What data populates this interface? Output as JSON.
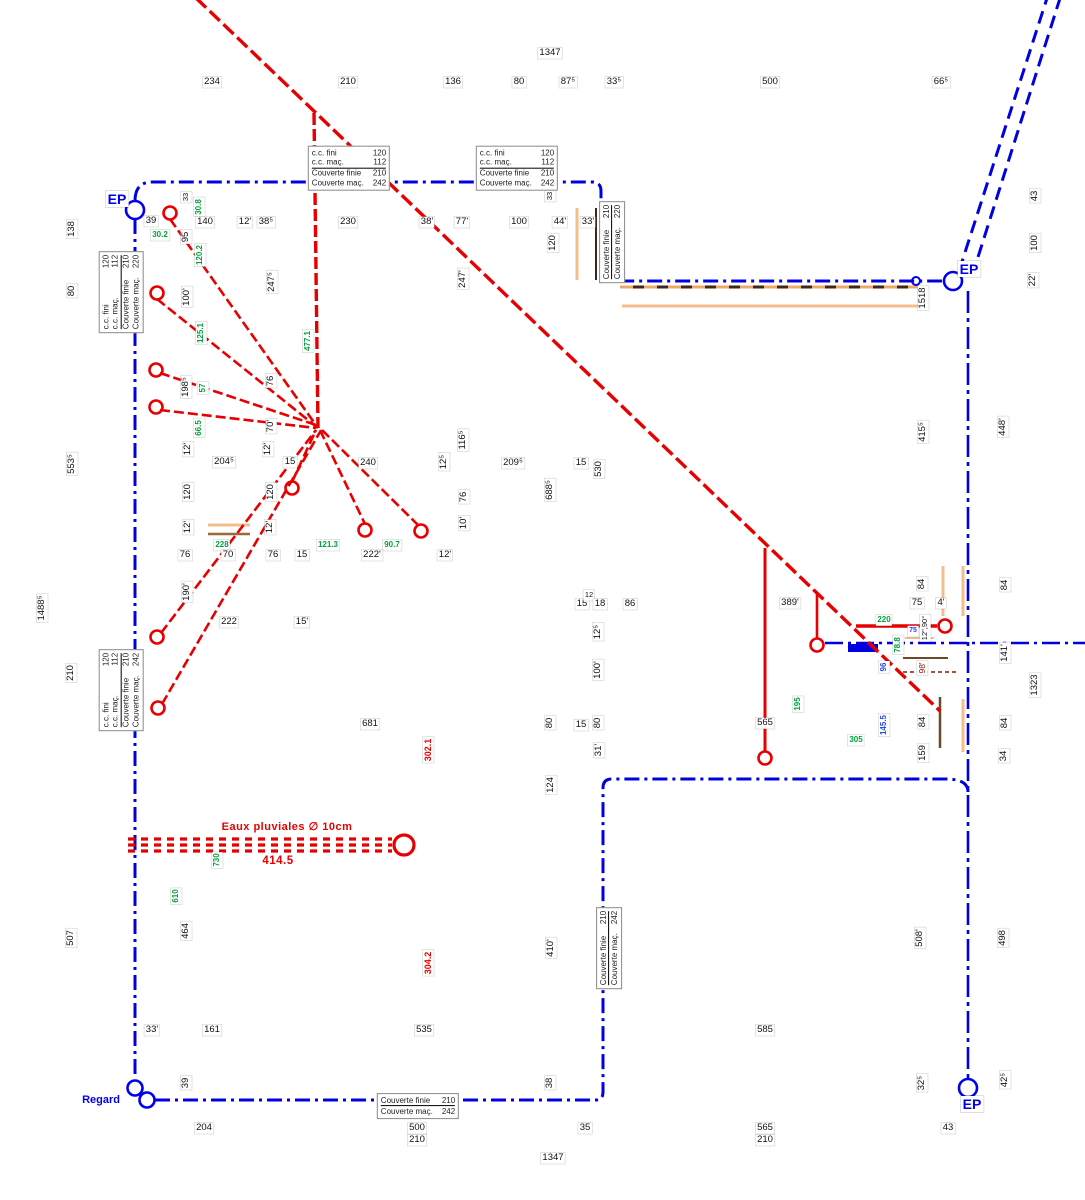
{
  "drawing": {
    "ep_label": "EP",
    "regard_label": "Regard",
    "colors": {
      "boundary_blue": "#0000e0",
      "pipe_red": "#e80000",
      "elevation_green": "#00a33d",
      "note_blue": "#2847e8",
      "note_darkred": "#8b1a00",
      "tan": "#f0b888"
    }
  },
  "infoboxes": [
    {
      "x": 349,
      "y": 168,
      "rot": 0,
      "div": 1,
      "rows": [
        [
          "c.c. fini",
          "120"
        ],
        [
          "c.c. maç.",
          "112"
        ],
        [
          "Couverte finie",
          "210"
        ],
        [
          "Couverte maç.",
          "242"
        ]
      ]
    },
    {
      "x": 517,
      "y": 168,
      "rot": 0,
      "div": 1,
      "rows": [
        [
          "c.c. fini",
          "120"
        ],
        [
          "c.c. maç.",
          "112"
        ],
        [
          "Couverte finie",
          "210"
        ],
        [
          "Couverte maç.",
          "242"
        ]
      ]
    },
    {
      "x": 121,
      "y": 292,
      "rot": 1,
      "div": 1,
      "rows": [
        [
          "c.c. fini",
          "120"
        ],
        [
          "c.c. maç.",
          "112"
        ],
        [
          "Couverte finie",
          "210"
        ],
        [
          "Couverte maç.",
          "220"
        ]
      ]
    },
    {
      "x": 121,
      "y": 690,
      "rot": 1,
      "div": 1,
      "rows": [
        [
          "c.c. fini",
          "120"
        ],
        [
          "c.c. maç.",
          "112"
        ],
        [
          "Couverte finie",
          "210"
        ],
        [
          "Couverte maç.",
          "242"
        ]
      ]
    },
    {
      "x": 612,
      "y": 242,
      "rot": 1,
      "div": 0,
      "rows": [
        [
          "Couverte finie",
          "210"
        ],
        [
          "Couverte maç.",
          "220"
        ]
      ]
    },
    {
      "x": 609,
      "y": 948,
      "rot": 1,
      "div": 0,
      "rows": [
        [
          "Couverte finie",
          "210"
        ],
        [
          "Couverte maç.",
          "242"
        ]
      ]
    },
    {
      "x": 418,
      "y": 1106,
      "rot": 0,
      "div": 0,
      "rows": [
        [
          "Couverte finie",
          "210"
        ],
        [
          "Couverte maç.",
          "242"
        ]
      ]
    }
  ],
  "ep_markers": [
    {
      "cx": 135,
      "cy": 210,
      "lx": 117,
      "ly": 199
    },
    {
      "cx": 953,
      "cy": 281,
      "lx": 969,
      "ly": 269
    },
    {
      "cx": 968,
      "cy": 1088,
      "lx": 972,
      "ly": 1104
    }
  ],
  "regard": {
    "x": 138,
    "y": 1100
  },
  "regard_circles": [
    [
      135,
      1088
    ],
    [
      147,
      1100
    ]
  ],
  "fixtures": [
    [
      170,
      213
    ],
    [
      157,
      293
    ],
    [
      156,
      370
    ],
    [
      156,
      407
    ],
    [
      292,
      488
    ],
    [
      365,
      530
    ],
    [
      421,
      531
    ],
    [
      157,
      637
    ],
    [
      158,
      708
    ],
    [
      765,
      758
    ],
    [
      817,
      645
    ],
    [
      945,
      626
    ]
  ],
  "labels": [
    {
      "t": "1347",
      "x": 550,
      "y": 53
    },
    {
      "t": "234",
      "x": 212,
      "y": 82
    },
    {
      "t": "210",
      "x": 348,
      "y": 82
    },
    {
      "t": "136",
      "x": 453,
      "y": 82
    },
    {
      "t": "80",
      "x": 519,
      "y": 82
    },
    {
      "t": "87⁵",
      "x": 568,
      "y": 82
    },
    {
      "t": "33⁵",
      "x": 614,
      "y": 82
    },
    {
      "t": "500",
      "x": 770,
      "y": 82
    },
    {
      "t": "66⁵",
      "x": 941,
      "y": 82
    },
    {
      "t": "33",
      "x": 186,
      "y": 197,
      "r": 1,
      "fs": 7.5
    },
    {
      "t": "39",
      "x": 151,
      "y": 221
    },
    {
      "t": "140",
      "x": 205,
      "y": 222
    },
    {
      "t": "12'",
      "x": 245,
      "y": 222
    },
    {
      "t": "38⁵",
      "x": 266,
      "y": 222
    },
    {
      "t": "230",
      "x": 348,
      "y": 222
    },
    {
      "t": "38'",
      "x": 427,
      "y": 222
    },
    {
      "t": "77'",
      "x": 462,
      "y": 222
    },
    {
      "t": "100",
      "x": 519,
      "y": 222
    },
    {
      "t": "44'",
      "x": 560,
      "y": 222
    },
    {
      "t": "33'",
      "x": 588,
      "y": 222
    },
    {
      "t": "33",
      "x": 550,
      "y": 196,
      "r": 1,
      "fs": 7.5
    },
    {
      "t": "120",
      "x": 553,
      "y": 243,
      "r": 1
    },
    {
      "t": "30.8",
      "x": 199,
      "y": 207,
      "r": 1,
      "c": "g"
    },
    {
      "t": "30.2",
      "x": 160,
      "y": 235,
      "c": "g"
    },
    {
      "t": "95",
      "x": 186,
      "y": 237,
      "r": 1
    },
    {
      "t": "120.2",
      "x": 200,
      "y": 255,
      "r": 1,
      "c": "g"
    },
    {
      "t": "100'",
      "x": 187,
      "y": 297,
      "r": 1
    },
    {
      "t": "247⁵",
      "x": 272,
      "y": 282,
      "r": 1
    },
    {
      "t": "247'",
      "x": 463,
      "y": 279,
      "r": 1
    },
    {
      "t": "138",
      "x": 72,
      "y": 229,
      "r": 1
    },
    {
      "t": "80",
      "x": 72,
      "y": 291,
      "r": 1
    },
    {
      "t": "553⁵",
      "x": 72,
      "y": 464,
      "r": 1
    },
    {
      "t": "1488⁵",
      "x": 42,
      "y": 608,
      "r": 1
    },
    {
      "t": "210",
      "x": 71,
      "y": 673,
      "r": 1
    },
    {
      "t": "507",
      "x": 71,
      "y": 938,
      "r": 1
    },
    {
      "t": "43",
      "x": 1035,
      "y": 196,
      "r": 1
    },
    {
      "t": "100",
      "x": 1035,
      "y": 243,
      "r": 1
    },
    {
      "t": "22'",
      "x": 1033,
      "y": 280,
      "r": 1
    },
    {
      "t": "1518",
      "x": 923,
      "y": 298,
      "r": 1
    },
    {
      "t": "415⁵",
      "x": 923,
      "y": 432,
      "r": 1
    },
    {
      "t": "448'",
      "x": 1003,
      "y": 427,
      "r": 1
    },
    {
      "t": "84",
      "x": 1005,
      "y": 585,
      "r": 1
    },
    {
      "t": "141'",
      "x": 1005,
      "y": 653,
      "r": 1
    },
    {
      "t": "1323",
      "x": 1035,
      "y": 685,
      "r": 1
    },
    {
      "t": "84",
      "x": 1005,
      "y": 723,
      "r": 1
    },
    {
      "t": "34",
      "x": 1004,
      "y": 756,
      "r": 1
    },
    {
      "t": "508'",
      "x": 920,
      "y": 938,
      "r": 1
    },
    {
      "t": "498",
      "x": 1003,
      "y": 938,
      "r": 1
    },
    {
      "t": "42⁵",
      "x": 1005,
      "y": 1080,
      "r": 1
    },
    {
      "t": "32⁵",
      "x": 922,
      "y": 1083,
      "r": 1
    },
    {
      "t": "198⁵",
      "x": 186,
      "y": 387,
      "r": 1
    },
    {
      "t": "125.1",
      "x": 201,
      "y": 333,
      "r": 1,
      "c": "g"
    },
    {
      "t": "57",
      "x": 203,
      "y": 388,
      "r": 1,
      "c": "g"
    },
    {
      "t": "66.5",
      "x": 199,
      "y": 428,
      "r": 1,
      "c": "g"
    },
    {
      "t": "76",
      "x": 271,
      "y": 381,
      "r": 1
    },
    {
      "t": "70'",
      "x": 271,
      "y": 426,
      "r": 1
    },
    {
      "t": "477.1",
      "x": 308,
      "y": 341,
      "r": 1,
      "c": "g"
    },
    {
      "t": "12'",
      "x": 188,
      "y": 449,
      "r": 1
    },
    {
      "t": "12'",
      "x": 268,
      "y": 449,
      "r": 1
    },
    {
      "t": "204⁵",
      "x": 224,
      "y": 462
    },
    {
      "t": "15",
      "x": 290,
      "y": 462
    },
    {
      "t": "240",
      "x": 368,
      "y": 463
    },
    {
      "t": "12⁵",
      "x": 444,
      "y": 462,
      "r": 1
    },
    {
      "t": "116⁵",
      "x": 463,
      "y": 440,
      "r": 1
    },
    {
      "t": "120",
      "x": 188,
      "y": 492,
      "r": 1
    },
    {
      "t": "120",
      "x": 271,
      "y": 492,
      "r": 1
    },
    {
      "t": "12'",
      "x": 188,
      "y": 527,
      "r": 1
    },
    {
      "t": "12'",
      "x": 270,
      "y": 527,
      "r": 1
    },
    {
      "t": "228",
      "x": 222,
      "y": 545,
      "c": "g"
    },
    {
      "t": "121.3",
      "x": 328,
      "y": 545,
      "c": "g"
    },
    {
      "t": "90.7",
      "x": 392,
      "y": 545,
      "c": "g"
    },
    {
      "t": "76",
      "x": 185,
      "y": 555
    },
    {
      "t": "70",
      "x": 228,
      "y": 555
    },
    {
      "t": "76",
      "x": 273,
      "y": 555
    },
    {
      "t": "15",
      "x": 302,
      "y": 555
    },
    {
      "t": "222'",
      "x": 372,
      "y": 555
    },
    {
      "t": "12'",
      "x": 445,
      "y": 555
    },
    {
      "t": "190'",
      "x": 187,
      "y": 592,
      "r": 1
    },
    {
      "t": "222",
      "x": 229,
      "y": 622
    },
    {
      "t": "15'",
      "x": 302,
      "y": 622
    },
    {
      "t": "209⁵",
      "x": 513,
      "y": 463
    },
    {
      "t": "15",
      "x": 581,
      "y": 463
    },
    {
      "t": "530",
      "x": 599,
      "y": 469,
      "r": 1
    },
    {
      "t": "688⁵",
      "x": 550,
      "y": 490,
      "r": 1
    },
    {
      "t": "76",
      "x": 464,
      "y": 497,
      "r": 1
    },
    {
      "t": "10'",
      "x": 464,
      "y": 523,
      "r": 1
    },
    {
      "t": "15",
      "x": 582,
      "y": 604
    },
    {
      "t": "12",
      "x": 589,
      "y": 595,
      "fs": 7.5
    },
    {
      "t": "18",
      "x": 600,
      "y": 604
    },
    {
      "t": "86",
      "x": 630,
      "y": 604
    },
    {
      "t": "12⁵",
      "x": 598,
      "y": 632,
      "r": 1
    },
    {
      "t": "100'",
      "x": 598,
      "y": 670,
      "r": 1
    },
    {
      "t": "80",
      "x": 550,
      "y": 723,
      "r": 1
    },
    {
      "t": "15",
      "x": 581,
      "y": 725
    },
    {
      "t": "80",
      "x": 598,
      "y": 723,
      "r": 1
    },
    {
      "t": "31'",
      "x": 599,
      "y": 750,
      "r": 1
    },
    {
      "t": "124",
      "x": 551,
      "y": 785,
      "r": 1
    },
    {
      "t": "681",
      "x": 370,
      "y": 724
    },
    {
      "t": "565",
      "x": 765,
      "y": 723
    },
    {
      "t": "302.1",
      "x": 428,
      "y": 750,
      "r": 1,
      "c": "rd"
    },
    {
      "t": "304.2",
      "x": 428,
      "y": 963,
      "r": 1,
      "c": "rd"
    },
    {
      "t": "389'",
      "x": 790,
      "y": 603
    },
    {
      "t": "84",
      "x": 922,
      "y": 584,
      "r": 1
    },
    {
      "t": "75",
      "x": 917,
      "y": 603
    },
    {
      "t": "4'",
      "x": 941,
      "y": 603
    },
    {
      "t": "220",
      "x": 884,
      "y": 620,
      "c": "g"
    },
    {
      "t": "75",
      "x": 913,
      "y": 631,
      "c": "bl",
      "fs": 7
    },
    {
      "t": "12\",90°",
      "x": 925,
      "y": 628,
      "r": 1,
      "fs": 7.5
    },
    {
      "t": "78.8",
      "x": 898,
      "y": 645,
      "r": 1,
      "c": "g"
    },
    {
      "t": "96",
      "x": 884,
      "y": 667,
      "r": 1,
      "c": "bl"
    },
    {
      "t": "98'",
      "x": 922,
      "y": 668,
      "r": 1,
      "c": "drd"
    },
    {
      "t": "195",
      "x": 798,
      "y": 704,
      "r": 1,
      "c": "g"
    },
    {
      "t": "145.5",
      "x": 884,
      "y": 725,
      "r": 1,
      "c": "bl"
    },
    {
      "t": "305",
      "x": 856,
      "y": 740,
      "c": "g"
    },
    {
      "t": "84",
      "x": 923,
      "y": 722,
      "r": 1
    },
    {
      "t": "159",
      "x": 923,
      "y": 753,
      "r": 1
    },
    {
      "t": "730",
      "x": 217,
      "y": 860,
      "r": 1,
      "c": "g"
    },
    {
      "t": "610",
      "x": 176,
      "y": 896,
      "r": 1,
      "c": "g"
    },
    {
      "t": "464",
      "x": 186,
      "y": 931,
      "r": 1
    },
    {
      "t": "Eaux pluviales ∅ 10cm",
      "x": 287,
      "y": 827,
      "c": "rdb",
      "fs": 11
    },
    {
      "t": "414.5",
      "x": 278,
      "y": 861,
      "c": "rdb"
    },
    {
      "t": "33'",
      "x": 152,
      "y": 1030
    },
    {
      "t": "161",
      "x": 212,
      "y": 1030
    },
    {
      "t": "535",
      "x": 424,
      "y": 1030
    },
    {
      "t": "585",
      "x": 765,
      "y": 1030
    },
    {
      "t": "410'",
      "x": 551,
      "y": 948,
      "r": 1
    },
    {
      "t": "38",
      "x": 550,
      "y": 1083,
      "r": 1
    },
    {
      "t": "39",
      "x": 186,
      "y": 1083,
      "r": 1
    },
    {
      "t": "204",
      "x": 204,
      "y": 1128
    },
    {
      "t": "500",
      "x": 417,
      "y": 1128
    },
    {
      "t": "210",
      "x": 417,
      "y": 1140
    },
    {
      "t": "35",
      "x": 585,
      "y": 1128
    },
    {
      "t": "1347",
      "x": 553,
      "y": 1158
    },
    {
      "t": "565",
      "x": 765,
      "y": 1128
    },
    {
      "t": "210",
      "x": 765,
      "y": 1140
    },
    {
      "t": "43",
      "x": 948,
      "y": 1128
    }
  ]
}
